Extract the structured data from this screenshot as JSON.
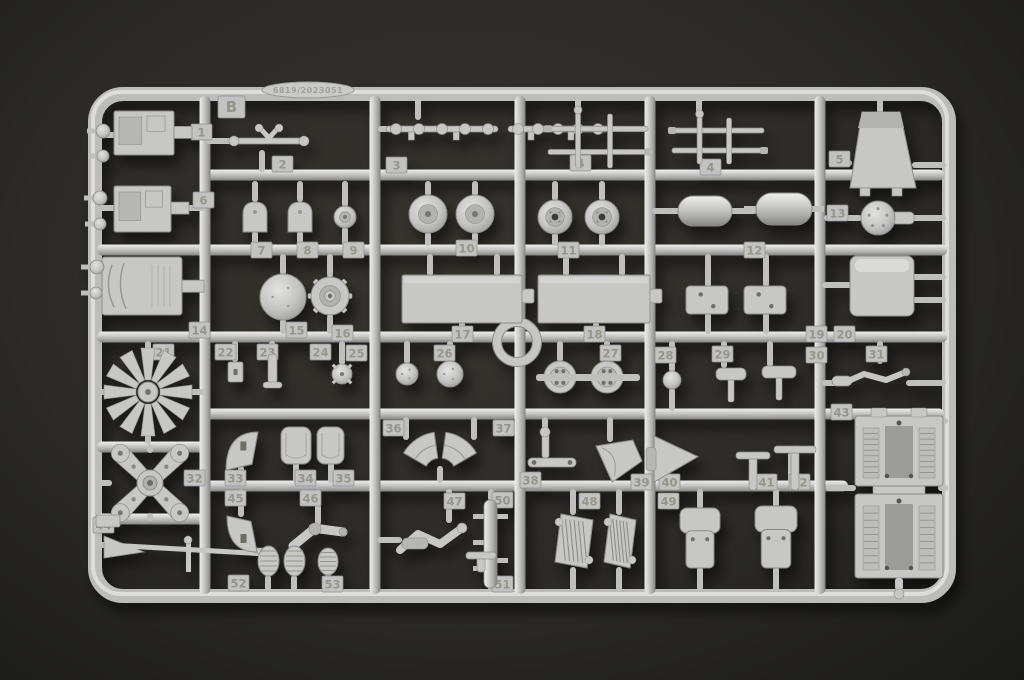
{
  "scene": {
    "background_center": "#37352f",
    "background_edge": "#191917",
    "plastic": "#c7c7c6",
    "plastic_highlight": "#e9e9e8",
    "plastic_shadow": "#828281",
    "edge_stroke": "#8b8b8a",
    "tag_fill": "#c2c2c1",
    "tag_text": "#95958c",
    "hole_color": "#55544f"
  },
  "sprue": {
    "letter": "B",
    "mold_code": "6819/2023051"
  },
  "frame": {
    "x": 95,
    "y": 94,
    "w": 854,
    "h": 502,
    "rx": 28,
    "stroke": 14
  },
  "rails": {
    "h": [
      {
        "y": 175,
        "x1": 205,
        "x2": 944
      },
      {
        "y": 250,
        "x1": 97,
        "x2": 947
      },
      {
        "y": 337,
        "x1": 97,
        "x2": 947
      },
      {
        "y": 414,
        "x1": 205,
        "x2": 944
      },
      {
        "y": 486,
        "x1": 205,
        "x2": 848
      },
      {
        "y": 447,
        "x1": 97,
        "x2": 205
      },
      {
        "y": 519,
        "x1": 97,
        "x2": 205
      }
    ],
    "v": [
      {
        "x": 205,
        "y1": 96,
        "y2": 594
      },
      {
        "x": 375,
        "y1": 96,
        "y2": 594
      },
      {
        "x": 520,
        "y1": 96,
        "y2": 594
      },
      {
        "x": 650,
        "y1": 96,
        "y2": 594
      },
      {
        "x": 820,
        "y1": 96,
        "y2": 594
      }
    ]
  },
  "runners": {
    "v": [
      [
        262,
        150,
        172
      ],
      [
        418,
        98,
        120
      ],
      [
        578,
        98,
        112
      ],
      [
        699,
        98,
        116
      ],
      [
        880,
        98,
        114
      ],
      [
        255,
        181,
        202
      ],
      [
        255,
        231,
        246
      ],
      [
        300,
        181,
        202
      ],
      [
        300,
        231,
        246
      ],
      [
        345,
        181,
        207
      ],
      [
        345,
        227,
        246
      ],
      [
        428,
        181,
        196
      ],
      [
        428,
        232,
        246
      ],
      [
        475,
        181,
        196
      ],
      [
        475,
        232,
        246
      ],
      [
        555,
        181,
        201
      ],
      [
        555,
        233,
        246
      ],
      [
        602,
        181,
        201
      ],
      [
        602,
        233,
        246
      ],
      [
        283,
        254,
        275
      ],
      [
        283,
        319,
        334
      ],
      [
        330,
        254,
        278
      ],
      [
        330,
        314,
        334
      ],
      [
        430,
        254,
        276
      ],
      [
        497,
        254,
        276
      ],
      [
        462,
        322,
        334
      ],
      [
        566,
        254,
        276
      ],
      [
        622,
        254,
        276
      ],
      [
        596,
        322,
        334
      ],
      [
        708,
        254,
        287
      ],
      [
        708,
        313,
        334
      ],
      [
        766,
        254,
        287
      ],
      [
        766,
        313,
        334
      ],
      [
        148,
        341,
        350
      ],
      [
        148,
        434,
        444
      ],
      [
        150,
        444,
        453
      ],
      [
        150,
        513,
        521
      ],
      [
        235,
        341,
        362
      ],
      [
        272,
        341,
        355
      ],
      [
        342,
        341,
        365
      ],
      [
        407,
        341,
        364
      ],
      [
        450,
        341,
        362
      ],
      [
        560,
        341,
        362
      ],
      [
        607,
        341,
        362
      ],
      [
        672,
        341,
        372
      ],
      [
        672,
        388,
        411
      ],
      [
        724,
        341,
        368
      ],
      [
        770,
        341,
        367
      ],
      [
        880,
        341,
        364
      ],
      [
        406,
        417,
        440
      ],
      [
        474,
        417,
        440
      ],
      [
        440,
        466,
        483
      ],
      [
        545,
        417,
        432
      ],
      [
        610,
        417,
        442
      ],
      [
        752,
        460,
        483
      ],
      [
        791,
        452,
        483
      ],
      [
        241,
        466,
        483
      ],
      [
        296,
        462,
        483
      ],
      [
        331,
        462,
        483
      ],
      [
        241,
        489,
        517
      ],
      [
        318,
        489,
        525
      ],
      [
        449,
        489,
        523
      ],
      [
        573,
        489,
        515
      ],
      [
        573,
        567,
        591
      ],
      [
        619,
        489,
        515
      ],
      [
        619,
        567,
        591
      ],
      [
        700,
        489,
        509
      ],
      [
        700,
        567,
        591
      ],
      [
        776,
        489,
        507
      ],
      [
        776,
        567,
        591
      ],
      [
        491,
        489,
        501
      ],
      [
        491,
        587,
        591
      ],
      [
        268,
        575,
        591
      ],
      [
        294,
        575,
        591
      ],
      [
        328,
        574,
        591
      ]
    ],
    "h": [
      [
        135,
        98,
        116
      ],
      [
        135,
        174,
        206
      ],
      [
        208,
        98,
        116
      ],
      [
        208,
        171,
        206
      ],
      [
        286,
        182,
        206
      ],
      [
        163,
        830,
        852
      ],
      [
        165,
        912,
        946
      ],
      [
        218,
        824,
        862
      ],
      [
        218,
        894,
        946
      ],
      [
        285,
        822,
        852
      ],
      [
        277,
        912,
        946
      ],
      [
        300,
        912,
        946
      ],
      [
        211,
        652,
        679
      ],
      [
        211,
        731,
        757
      ],
      [
        209,
        811,
        822
      ],
      [
        141,
        206,
        232
      ],
      [
        129,
        378,
        390
      ],
      [
        129,
        607,
        648
      ],
      [
        383,
        822,
        840
      ],
      [
        383,
        906,
        946
      ],
      [
        421,
        938,
        948
      ],
      [
        488,
        826,
        856
      ],
      [
        488,
        938,
        948
      ],
      [
        463,
        651,
        661
      ],
      [
        540,
        377,
        402
      ],
      [
        545,
        96,
        108
      ],
      [
        483,
        98,
        112
      ],
      [
        483,
        188,
        206
      ],
      [
        392,
        96,
        106
      ],
      [
        392,
        190,
        206
      ]
    ]
  },
  "center_ring": {
    "cx": 517,
    "cy": 342,
    "r": 20
  },
  "tags": [
    {
      "n": "1",
      "x": 191,
      "y": 124
    },
    {
      "n": "2",
      "x": 272,
      "y": 156
    },
    {
      "n": "3",
      "x": 386,
      "y": 157
    },
    {
      "n": "4",
      "x": 570,
      "y": 155
    },
    {
      "n": "4",
      "x": 700,
      "y": 159
    },
    {
      "n": "5",
      "x": 829,
      "y": 151
    },
    {
      "n": "6",
      "x": 193,
      "y": 192
    },
    {
      "n": "7",
      "x": 251,
      "y": 242
    },
    {
      "n": "8",
      "x": 297,
      "y": 242
    },
    {
      "n": "9",
      "x": 343,
      "y": 242
    },
    {
      "n": "10",
      "x": 456,
      "y": 240
    },
    {
      "n": "11",
      "x": 558,
      "y": 242
    },
    {
      "n": "12",
      "x": 744,
      "y": 242
    },
    {
      "n": "13",
      "x": 827,
      "y": 205
    },
    {
      "n": "14",
      "x": 189,
      "y": 322
    },
    {
      "n": "15",
      "x": 286,
      "y": 322
    },
    {
      "n": "16",
      "x": 332,
      "y": 325
    },
    {
      "n": "17",
      "x": 452,
      "y": 326
    },
    {
      "n": "18",
      "x": 584,
      "y": 326
    },
    {
      "n": "19",
      "x": 806,
      "y": 326
    },
    {
      "n": "20",
      "x": 834,
      "y": 326
    },
    {
      "n": "21",
      "x": 153,
      "y": 344
    },
    {
      "n": "22",
      "x": 215,
      "y": 344
    },
    {
      "n": "23",
      "x": 257,
      "y": 344
    },
    {
      "n": "24",
      "x": 310,
      "y": 344
    },
    {
      "n": "25",
      "x": 346,
      "y": 345
    },
    {
      "n": "26",
      "x": 434,
      "y": 345
    },
    {
      "n": "27",
      "x": 600,
      "y": 345
    },
    {
      "n": "28",
      "x": 655,
      "y": 347
    },
    {
      "n": "29",
      "x": 712,
      "y": 346
    },
    {
      "n": "30",
      "x": 806,
      "y": 347
    },
    {
      "n": "31",
      "x": 866,
      "y": 346
    },
    {
      "n": "32",
      "x": 184,
      "y": 470
    },
    {
      "n": "33",
      "x": 225,
      "y": 470
    },
    {
      "n": "34",
      "x": 295,
      "y": 470
    },
    {
      "n": "35",
      "x": 333,
      "y": 470
    },
    {
      "n": "36",
      "x": 383,
      "y": 420
    },
    {
      "n": "37",
      "x": 493,
      "y": 420
    },
    {
      "n": "38",
      "x": 520,
      "y": 472
    },
    {
      "n": "39",
      "x": 631,
      "y": 474
    },
    {
      "n": "40",
      "x": 659,
      "y": 474
    },
    {
      "n": "41",
      "x": 756,
      "y": 474
    },
    {
      "n": "42",
      "x": 789,
      "y": 474
    },
    {
      "n": "43",
      "x": 831,
      "y": 404
    },
    {
      "n": "44",
      "x": 93,
      "y": 517
    },
    {
      "n": "45",
      "x": 225,
      "y": 490
    },
    {
      "n": "46",
      "x": 300,
      "y": 490
    },
    {
      "n": "47",
      "x": 444,
      "y": 493
    },
    {
      "n": "48",
      "x": 579,
      "y": 493
    },
    {
      "n": "49",
      "x": 658,
      "y": 493
    },
    {
      "n": "50",
      "x": 492,
      "y": 492
    },
    {
      "n": "51",
      "x": 492,
      "y": 576
    },
    {
      "n": "52",
      "x": 228,
      "y": 575
    },
    {
      "n": "53",
      "x": 322,
      "y": 576
    }
  ],
  "parts": [
    {
      "n": "1",
      "shape": "panel",
      "x": 114,
      "y": 111,
      "w": 60,
      "h": 44
    },
    {
      "n": "6",
      "shape": "panel",
      "x": 114,
      "y": 186,
      "w": 57,
      "h": 46
    },
    {
      "n": "14",
      "shape": "box",
      "x": 102,
      "y": 257,
      "w": 80,
      "h": 58
    },
    {
      "n": "2",
      "shape": "wishbone",
      "x": 230,
      "y": 126,
      "w": 78,
      "h": 30
    },
    {
      "n": "3",
      "shape": "linkage",
      "x": 386,
      "y": 119,
      "w": 112,
      "h": 20
    },
    {
      "n": "3b",
      "shape": "linkage",
      "x": 508,
      "y": 119,
      "w": 100,
      "h": 20
    },
    {
      "n": "4",
      "shape": "ladder",
      "x": 548,
      "y": 110,
      "w": 100,
      "h": 58
    },
    {
      "n": "4b",
      "shape": "ladder",
      "x": 672,
      "y": 114,
      "w": 92,
      "h": 50
    },
    {
      "n": "5",
      "shape": "trapezoid",
      "x": 850,
      "y": 112,
      "w": 66,
      "h": 76
    },
    {
      "n": "7",
      "shape": "dome",
      "x": 243,
      "y": 202,
      "w": 24,
      "h": 30
    },
    {
      "n": "8",
      "shape": "dome",
      "x": 288,
      "y": 202,
      "w": 24,
      "h": 30
    },
    {
      "n": "9",
      "shape": "wheel",
      "cx": 345,
      "cy": 217,
      "r": 11
    },
    {
      "n": "10",
      "shape": "wheel",
      "cx": 428,
      "cy": 214,
      "r": 19
    },
    {
      "n": "10b",
      "shape": "wheel",
      "cx": 475,
      "cy": 214,
      "r": 19
    },
    {
      "n": "11",
      "shape": "wheel2",
      "cx": 555,
      "cy": 217,
      "r": 17
    },
    {
      "n": "11b",
      "shape": "wheel2",
      "cx": 602,
      "cy": 217,
      "r": 17
    },
    {
      "n": "12",
      "shape": "pill",
      "x": 678,
      "y": 196,
      "w": 54,
      "h": 30
    },
    {
      "n": "12b",
      "shape": "pill",
      "x": 756,
      "y": 193,
      "w": 56,
      "h": 32
    },
    {
      "n": "13",
      "shape": "flange",
      "cx": 878,
      "cy": 218,
      "r": 17
    },
    {
      "n": "15",
      "shape": "disc",
      "cx": 283,
      "cy": 297,
      "r": 23
    },
    {
      "n": "16",
      "shape": "sprocket",
      "cx": 330,
      "cy": 296,
      "r": 19
    },
    {
      "n": "17",
      "shape": "bigpanel",
      "x": 402,
      "y": 275,
      "w": 120,
      "h": 48
    },
    {
      "n": "18",
      "shape": "bigpanel",
      "x": 538,
      "y": 275,
      "w": 112,
      "h": 48
    },
    {
      "n": "19",
      "shape": "bracket",
      "x": 686,
      "y": 286,
      "w": 42,
      "h": 28
    },
    {
      "n": "19b",
      "shape": "bracket",
      "x": 744,
      "y": 286,
      "w": 42,
      "h": 28
    },
    {
      "n": "20",
      "shape": "box3d",
      "x": 850,
      "y": 256,
      "w": 64,
      "h": 60
    },
    {
      "n": "21",
      "shape": "star",
      "cx": 148,
      "cy": 392,
      "r": 44
    },
    {
      "n": "22",
      "shape": "smallrect",
      "x": 228,
      "y": 362,
      "w": 15,
      "h": 20
    },
    {
      "n": "23",
      "shape": "rod",
      "x": 268,
      "y": 354,
      "w": 9,
      "h": 30
    },
    {
      "n": "24",
      "shape": "spindle",
      "cx": 342,
      "cy": 374,
      "r": 10
    },
    {
      "n": "25",
      "shape": "disc",
      "cx": 407,
      "cy": 374,
      "r": 11
    },
    {
      "n": "26",
      "shape": "disc",
      "cx": 450,
      "cy": 374,
      "r": 13
    },
    {
      "n": "27",
      "shape": "drilled",
      "cx": 560,
      "cy": 377,
      "r": 16
    },
    {
      "n": "27b",
      "shape": "drilled",
      "cx": 607,
      "cy": 377,
      "r": 16
    },
    {
      "n": "27ax",
      "shape": "hstub",
      "x": 536,
      "y": 374,
      "w": 104,
      "h": 7
    },
    {
      "n": "28",
      "shape": "knob",
      "cx": 672,
      "cy": 380,
      "r": 9
    },
    {
      "n": "29",
      "shape": "tcap",
      "x": 716,
      "y": 368,
      "w": 30,
      "h": 12
    },
    {
      "n": "30",
      "shape": "tcap",
      "x": 762,
      "y": 366,
      "w": 34,
      "h": 12
    },
    {
      "n": "31",
      "shape": "lever",
      "x": 838,
      "y": 368,
      "w": 70,
      "h": 28
    },
    {
      "n": "32",
      "shape": "cross",
      "cx": 150,
      "cy": 483,
      "r": 42
    },
    {
      "n": "33",
      "shape": "blade",
      "x": 226,
      "y": 432,
      "w": 32,
      "h": 38,
      "flip": 0
    },
    {
      "n": "34",
      "shape": "seatback",
      "x": 281,
      "y": 427,
      "w": 30,
      "h": 37
    },
    {
      "n": "35",
      "shape": "seatback",
      "x": 317,
      "y": 427,
      "w": 27,
      "h": 37
    },
    {
      "n": "36",
      "shape": "wedge",
      "cx": 440,
      "cy": 474,
      "r1": 16,
      "r2": 42,
      "a1": -150,
      "a2": -98
    },
    {
      "n": "37",
      "shape": "wedge",
      "cx": 440,
      "cy": 474,
      "r1": 16,
      "r2": 42,
      "a1": -82,
      "a2": -30
    },
    {
      "n": "38",
      "shape": "crank",
      "x": 528,
      "y": 430,
      "w": 48,
      "h": 42
    },
    {
      "n": "39",
      "shape": "funnel",
      "x": 596,
      "y": 440,
      "w": 46,
      "h": 42,
      "dir": 0
    },
    {
      "n": "40",
      "shape": "funnel",
      "x": 654,
      "y": 436,
      "w": 44,
      "h": 46,
      "dir": 1
    },
    {
      "n": "41",
      "shape": "tpipe",
      "x": 736,
      "y": 452,
      "w": 34,
      "h": 38
    },
    {
      "n": "42",
      "shape": "tpipe",
      "x": 774,
      "y": 446,
      "w": 42,
      "h": 44
    },
    {
      "n": "43",
      "shape": "chassis",
      "x": 855,
      "y": 416,
      "w": 88
    },
    {
      "n": "44",
      "shape": "arm",
      "x": 100,
      "y": 528,
      "w": 168
    },
    {
      "n": "45",
      "shape": "blade",
      "x": 227,
      "y": 516,
      "w": 30,
      "h": 36,
      "flip": 1
    },
    {
      "n": "46",
      "shape": "elbow",
      "x": 293,
      "y": 524
    },
    {
      "n": "47",
      "shape": "armsmall",
      "x": 400,
      "y": 522
    },
    {
      "n": "48",
      "shape": "radiator",
      "x": 555,
      "y": 514,
      "w": 38,
      "h": 54
    },
    {
      "n": "48b",
      "shape": "radiator",
      "x": 604,
      "y": 514,
      "w": 32,
      "h": 54
    },
    {
      "n": "49",
      "shape": "seat",
      "x": 680,
      "y": 508,
      "w": 40,
      "h": 60
    },
    {
      "n": "49b",
      "shape": "seat",
      "x": 755,
      "y": 506,
      "w": 42,
      "h": 62
    },
    {
      "n": "50",
      "shape": "vladder",
      "x": 484,
      "y": 500,
      "w": 13,
      "h": 88
    },
    {
      "n": "51",
      "shape": "tpipe",
      "x": 466,
      "y": 552,
      "w": 30,
      "h": 20
    },
    {
      "n": "52",
      "shape": "ribbed",
      "x": 258,
      "y": 546,
      "w": 21,
      "h": 30
    },
    {
      "n": "52b",
      "shape": "ribbed",
      "x": 284,
      "y": 546,
      "w": 21,
      "h": 30
    },
    {
      "n": "53",
      "shape": "ribbed",
      "x": 318,
      "y": 548,
      "w": 20,
      "h": 27
    },
    {
      "n": "e1",
      "shape": "knob",
      "cx": 103,
      "cy": 131,
      "r": 7,
      "stub": "left"
    },
    {
      "n": "e2",
      "shape": "knob",
      "cx": 103,
      "cy": 156,
      "r": 6,
      "stub": "left"
    },
    {
      "n": "e3",
      "shape": "knob",
      "cx": 100,
      "cy": 198,
      "r": 7,
      "stub": "left"
    },
    {
      "n": "e4",
      "shape": "knob",
      "cx": 100,
      "cy": 224,
      "r": 6,
      "stub": "left"
    },
    {
      "n": "e5",
      "shape": "knob",
      "cx": 97,
      "cy": 267,
      "r": 7,
      "stub": "left"
    },
    {
      "n": "e6",
      "shape": "knob",
      "cx": 96,
      "cy": 293,
      "r": 6,
      "stub": "left"
    }
  ]
}
